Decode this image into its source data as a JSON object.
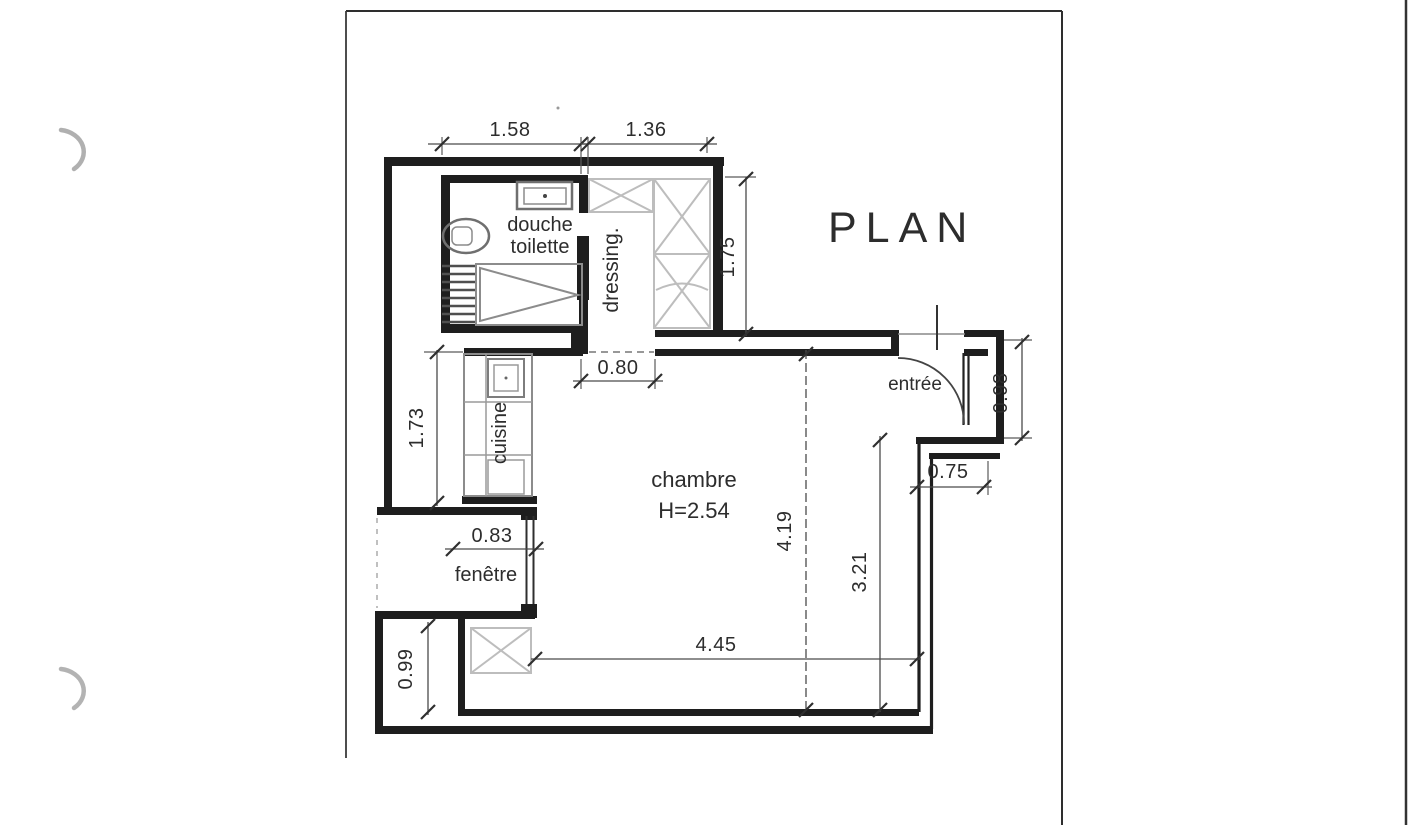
{
  "document": {
    "kind": "scanned architectural floor plan page",
    "title": "PLAN"
  },
  "plan": {
    "labels": {
      "plan_title": "PLAN",
      "douche": "douche",
      "toilette": "toilette",
      "dressing": "dressing.",
      "cuisine": "cuisine",
      "chambre": "chambre",
      "chambre_height": "H=2.54",
      "entree": "entrée",
      "fenetre": "fenêtre"
    },
    "dims": {
      "d158": "1.58",
      "d136": "1.36",
      "d175": "1.75",
      "d080": "0.80",
      "d173": "1.73",
      "d083": "0.83",
      "d099": "0.99",
      "d445": "4.45",
      "d419": "4.19",
      "d321": "3.21",
      "d075": "0.75",
      "d098": "0.98"
    },
    "colors": {
      "ink": "#2d2d2d",
      "wall": "#1e1e1e",
      "furniture_gray": "#8c8c8c",
      "light_gray": "#bdbdbd"
    }
  }
}
